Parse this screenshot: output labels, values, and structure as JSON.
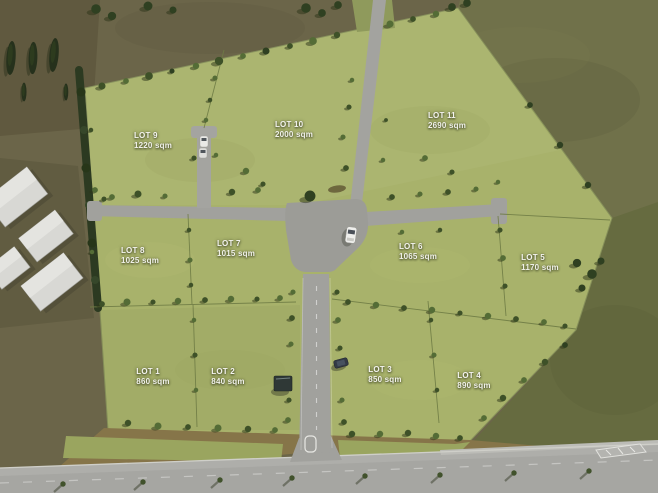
{
  "map": {
    "type": "aerial-subdivision-masterplan",
    "area_unit": "sqm",
    "lot_count": 11
  },
  "lots": [
    {
      "id": "lot-1",
      "name": "LOT 1",
      "area": "860 sqm"
    },
    {
      "id": "lot-2",
      "name": "LOT 2",
      "area": "840 sqm"
    },
    {
      "id": "lot-3",
      "name": "LOT 3",
      "area": "850 sqm"
    },
    {
      "id": "lot-4",
      "name": "LOT 4",
      "area": "890 sqm"
    },
    {
      "id": "lot-5",
      "name": "LOT 5",
      "area": "1170 sqm"
    },
    {
      "id": "lot-6",
      "name": "LOT 6",
      "area": "1065 sqm"
    },
    {
      "id": "lot-7",
      "name": "LOT 7",
      "area": "1015 sqm"
    },
    {
      "id": "lot-8",
      "name": "LOT 8",
      "area": "1025 sqm"
    },
    {
      "id": "lot-9",
      "name": "LOT 9",
      "area": "1220 sqm"
    },
    {
      "id": "lot-10",
      "name": "LOT 10",
      "area": "2000 sqm"
    },
    {
      "id": "lot-11",
      "name": "LOT 11",
      "area": "2690 sqm"
    }
  ],
  "colors": {
    "grass": "#a8b26b",
    "surrounding_field": "#6b6549",
    "road": "#a1a19d",
    "label_text": "#f4f4ef",
    "tree_dark": "#2f4021",
    "tree_mid": "#546c36"
  }
}
